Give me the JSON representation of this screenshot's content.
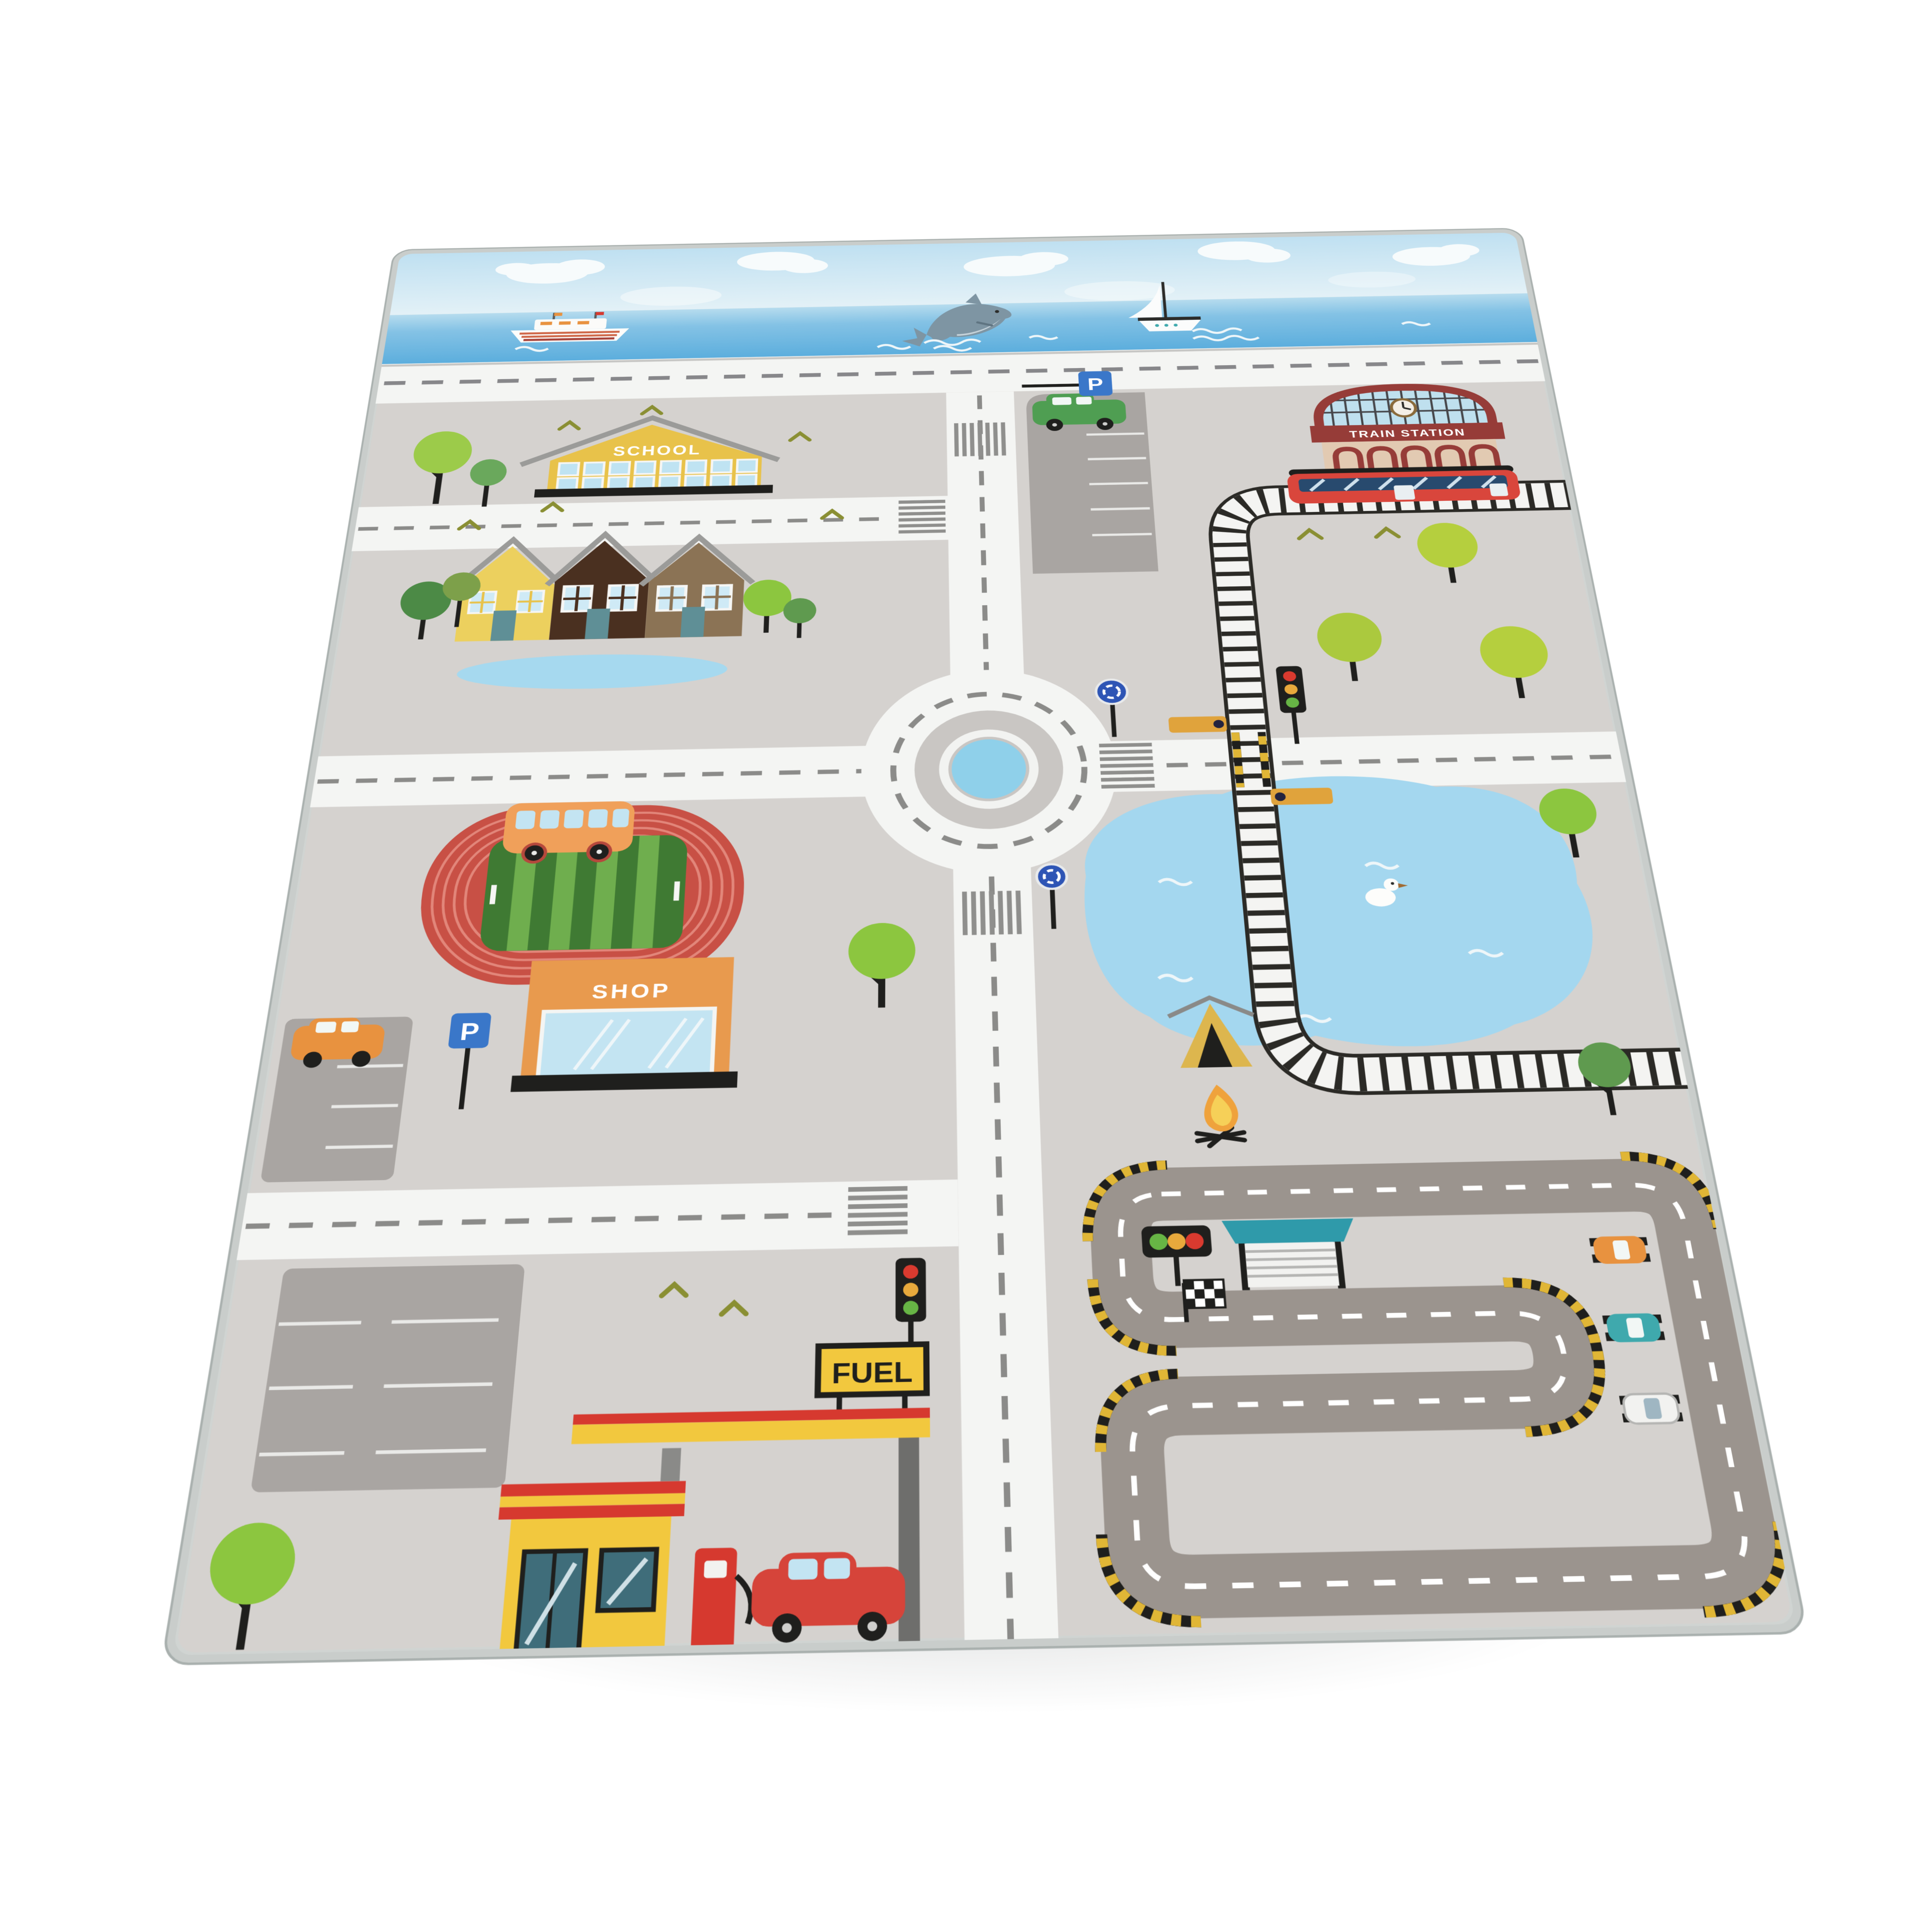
{
  "rug": {
    "labels": {
      "school": "SCHOOL",
      "train_station": "TRAIN STATION",
      "shop": "SHOP",
      "fuel": "FUEL",
      "parking": "P"
    },
    "colors": {
      "ground": "#d5d2cf",
      "road": "#f4f5f3",
      "road_marking": "#8b8b89",
      "sky": "#c7e3f2",
      "sea": "#63b2de",
      "roundabout_center": "#8fd0ea",
      "lake": "#a4d7ef",
      "parking_asphalt": "#a9a5a2",
      "race_asphalt": "#9b948e",
      "curb_yellow": "#e0b636",
      "school_yellow": "#e8c24a",
      "house_yellow": "#ecd05e",
      "house_brown": "#4a3020",
      "house_taupe": "#8b7355",
      "station_red": "#963c38",
      "station_beige": "#e2cab2",
      "train_red": "#d9463c",
      "shop_orange": "#e89a4e",
      "fuel_yellow": "#f2c83e",
      "fuel_red": "#d6392f",
      "field_track_red": "#c85045",
      "field_green": "#3f7a33",
      "tree_green": "#abc93e",
      "sign_blue": "#2e55b5",
      "traffic_red": "#d93a2f",
      "traffic_amber": "#e8a93c",
      "traffic_green": "#67b545",
      "tent_yellow": "#ddb64e"
    }
  }
}
